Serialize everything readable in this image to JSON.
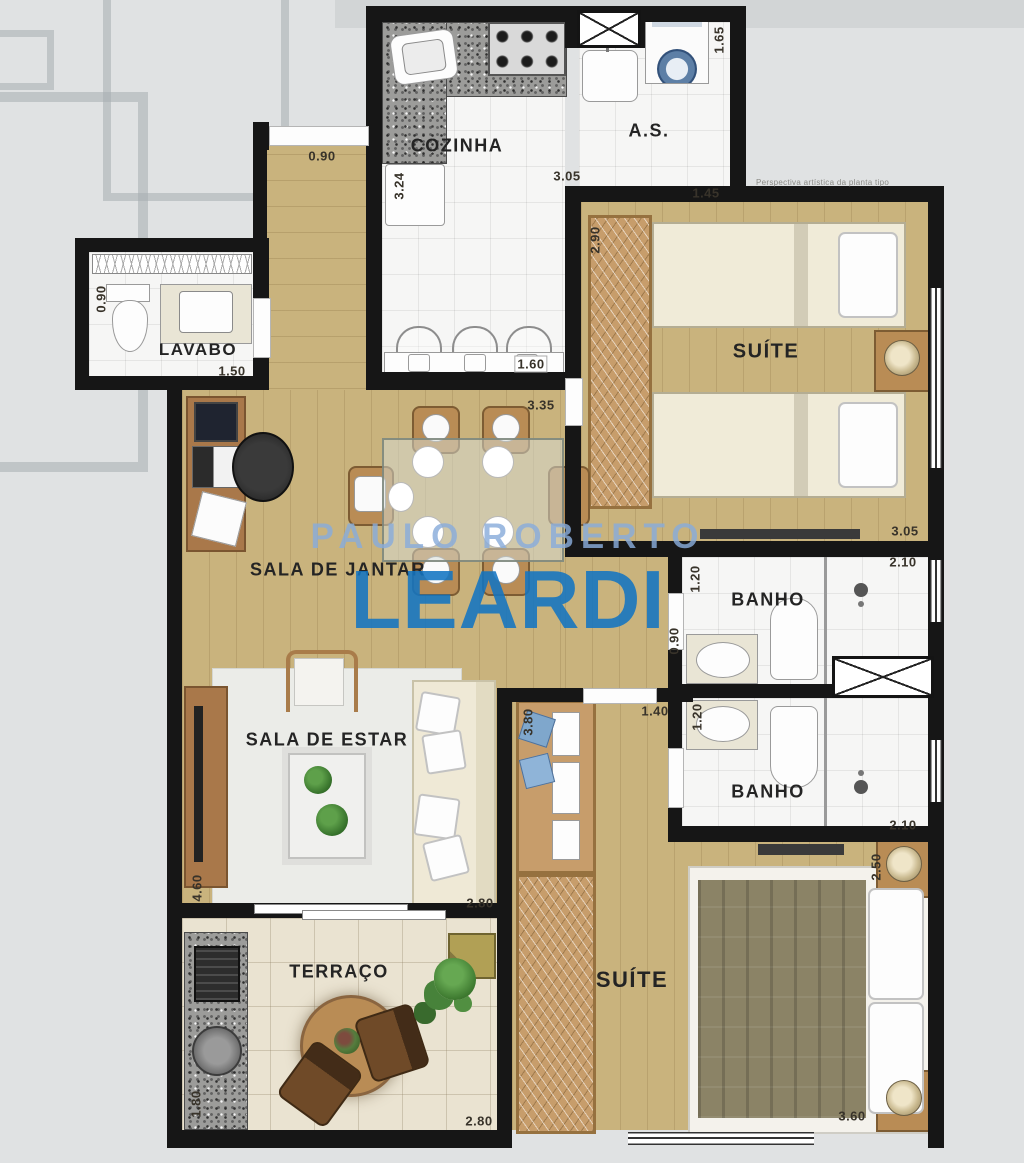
{
  "watermark": {
    "line1": "PAULO ROBERTO",
    "line2": "LEARDI"
  },
  "note": "Perspectiva artística da planta tipo",
  "rooms": {
    "cozinha": "COZINHA",
    "area_servico": "A.S.",
    "lavabo": "LAVABO",
    "suite1": "SUÍTE",
    "sala_jantar": "SALA DE JANTAR",
    "banho1": "BANHO",
    "banho2": "BANHO",
    "sala_estar": "SALA DE ESTAR",
    "terraco": "TERRAÇO",
    "suite2": "SUÍTE"
  },
  "dims": {
    "corridor_w": "0.90",
    "cozinha_h": "3.24",
    "cozinha_w": "3.05",
    "cozinha_counter": "1.60",
    "as_w": "1.45",
    "as_h": "1.65",
    "lavabo_h": "0.90",
    "lavabo_w": "1.50",
    "suite1_h": "2.90",
    "suite1_w": "3.05",
    "jantar_w": "3.35",
    "banho1_h": "1.20",
    "banho1_w": "2.10",
    "hall_h": "0.90",
    "suite2_top_w": "1.40",
    "banho2_h": "1.20",
    "banho2_w": "2.10",
    "suite2_h": "3.80",
    "suite2_right": "2.50",
    "suite2_w": "3.60",
    "estar_h": "4.60",
    "estar_w": "2.80",
    "terraco_h": "1.80",
    "terraco_w": "2.80"
  }
}
